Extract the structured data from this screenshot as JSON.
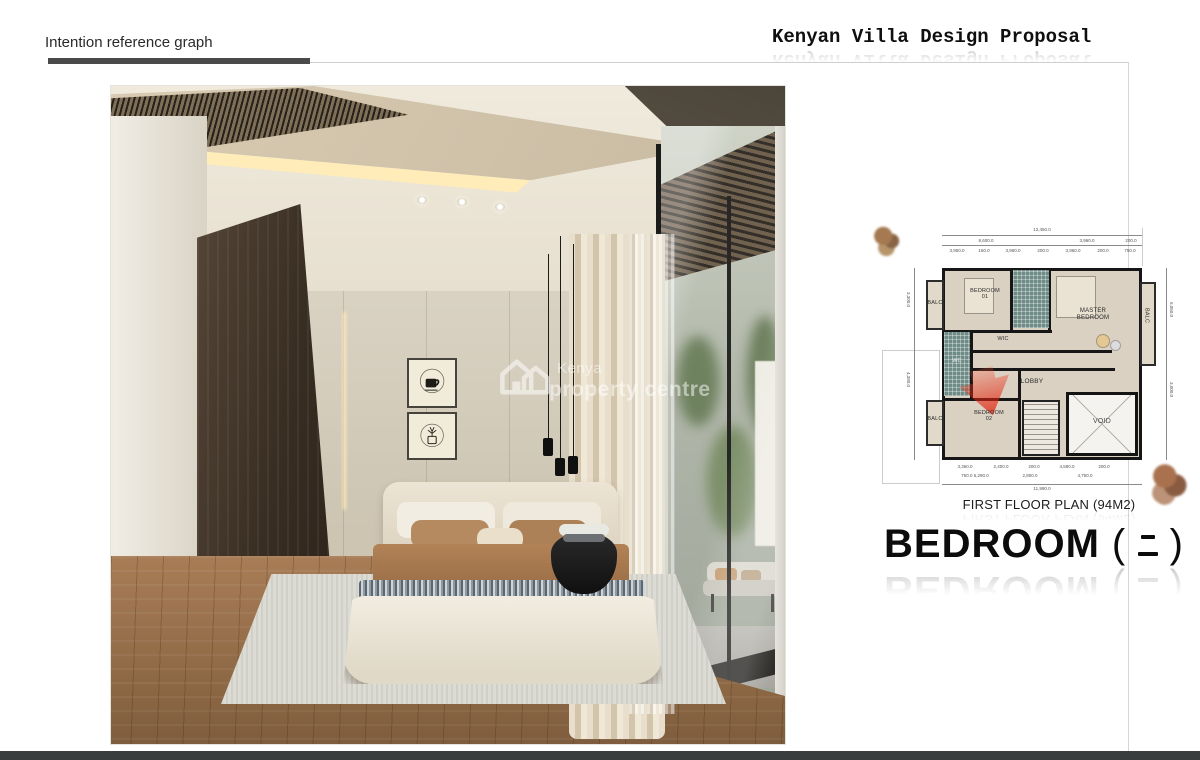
{
  "header": {
    "section_label": "Intention reference graph",
    "title": "Kenyan Villa Design Proposal"
  },
  "watermark": {
    "line1": "Kenya",
    "line2": "property centre"
  },
  "plan": {
    "caption": "FIRST FLOOR PLAN (94M2)",
    "rooms": {
      "balc_top_left": "BALC",
      "bedroom01_l1": "BEDROOM",
      "bedroom01_l2": "01",
      "master_l1": "MASTER",
      "master_l2": "BEDROOM",
      "balc_right": "BALC",
      "wic": "WIC",
      "wc": "WC",
      "lobby": "LOBBY",
      "bedroom02_l1": "BEDROOM",
      "bedroom02_l2": "02",
      "balc_bottom_left": "BALC",
      "void": "VOID"
    },
    "dims": {
      "top_total": "12,450.0",
      "top_row2": [
        "8,600.0",
        "3,960.0",
        "200.0"
      ],
      "top_row3": [
        "3,950.0",
        "150.0",
        "3,960.0",
        "200.0",
        "3,960.0",
        "200.0",
        "750.0"
      ],
      "bottom_row1": [
        "3,360.0",
        "2,400.0",
        "200.0",
        "4,580.0",
        "200.0"
      ],
      "bottom_row2": [
        "750.0 5,290.0",
        "2,800.0",
        "4,750.0"
      ],
      "bottom_total": "11,990.0",
      "left_col": [
        "3,300.0",
        "4,380.0"
      ],
      "right_col": [
        "6,050.0",
        "3,000.0"
      ]
    }
  },
  "captions": {
    "bedroom_full": "BEDROOM (二)",
    "bedroom_word": "BEDROOM",
    "paren_open": "(",
    "paren_close": ")"
  },
  "colors": {
    "highlight_red": "#e03422",
    "plan_tile_teal": "#6f8b85",
    "bottom_bar": "#3a3d3e"
  }
}
